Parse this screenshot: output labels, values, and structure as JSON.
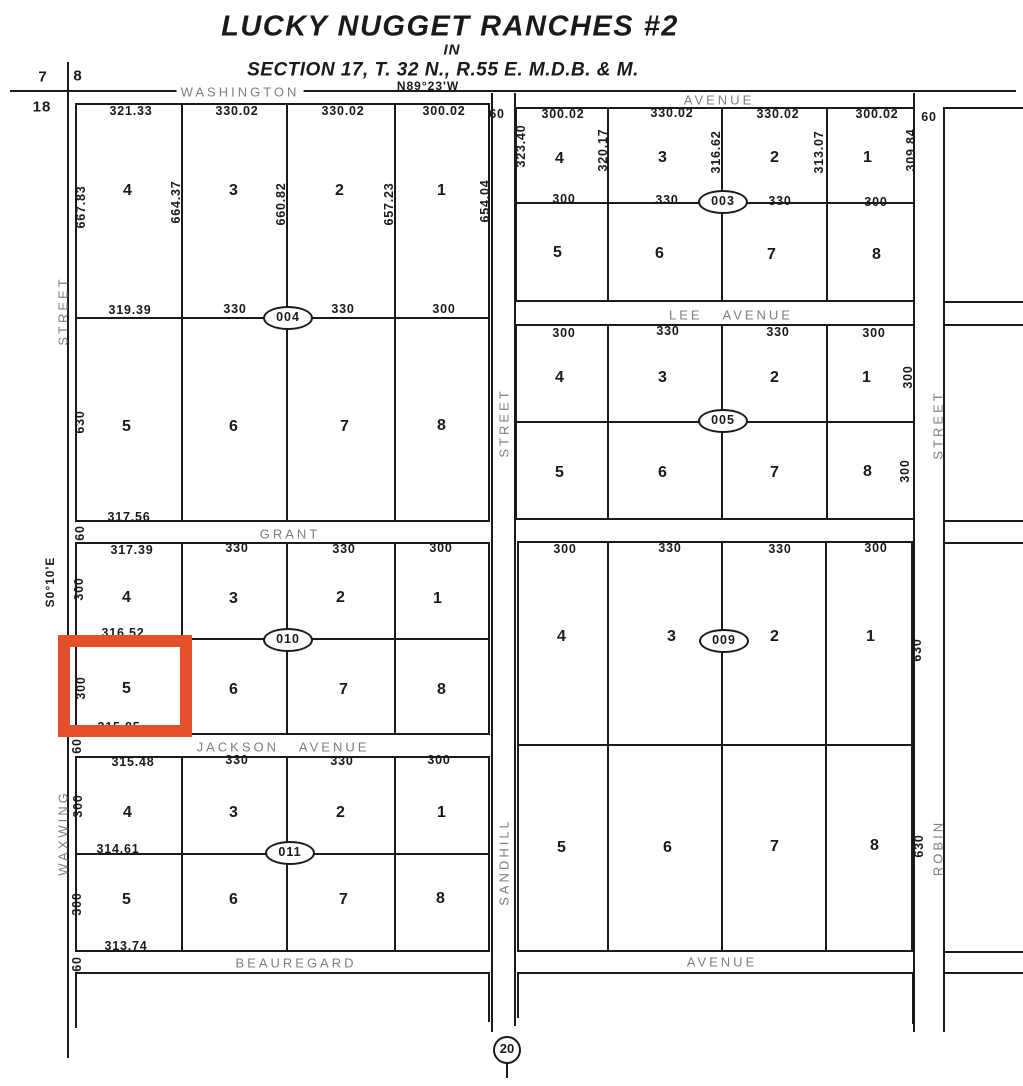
{
  "header": {
    "title": "LUCKY NUGGET RANCHES #2",
    "in_label": "IN",
    "section_line": "SECTION 17, T. 32 N., R.55 E. M.D.B. & M."
  },
  "bearings": {
    "north_line": "N89°23'W",
    "west_line": "S0°10'E"
  },
  "section_markers": {
    "nw_left": "7",
    "nw_right": "8",
    "nw_lower": "18",
    "south": "20"
  },
  "streets": {
    "washington": "WASHINGTON",
    "washington_suffix": "AVENUE",
    "lee": "LEE AVENUE",
    "grant": "GRANT",
    "jackson": "JACKSON AVENUE",
    "beauregard": "BEAUREGARD",
    "beauregard_suffix": "AVENUE",
    "waxwing": "WAXWING",
    "waxwing_type": "STREET",
    "sandhill": "SANDHILL",
    "sandhill_type": "STREET",
    "robin": "ROBIN",
    "robin_type": "STREET",
    "width": "60"
  },
  "blocks": {
    "b004": {
      "number": "004",
      "lots": [
        "4",
        "3",
        "2",
        "1",
        "5",
        "6",
        "7",
        "8"
      ],
      "top_dims": [
        "321.33",
        "330.02",
        "330.02",
        "300.02"
      ],
      "mid_dims": [
        "319.39",
        "330",
        "330",
        "300"
      ],
      "bottom_dim": "317.56",
      "depth_dims": [
        "667.83",
        "664.37",
        "660.82",
        "657.23",
        "654.04"
      ],
      "left_lower_depth": "630"
    },
    "b003": {
      "number": "003",
      "lots": [
        "4",
        "3",
        "2",
        "1",
        "5",
        "6",
        "7",
        "8"
      ],
      "top_dims": [
        "300.02",
        "330.02",
        "330.02",
        "300.02"
      ],
      "mid_dims": [
        "300",
        "330",
        "330",
        "300"
      ],
      "depth_dims": [
        "323.40",
        "320.17",
        "316.62",
        "313.07",
        "309.84"
      ]
    },
    "b005": {
      "number": "005",
      "lots": [
        "4",
        "3",
        "2",
        "1",
        "5",
        "6",
        "7",
        "8"
      ],
      "top_dims": [
        "300",
        "330",
        "330",
        "300"
      ],
      "right_depths": [
        "300",
        "300"
      ]
    },
    "b010": {
      "number": "010",
      "lots": [
        "4",
        "3",
        "2",
        "1",
        "5",
        "6",
        "7",
        "8"
      ],
      "top_dims": [
        "317.39",
        "330",
        "330",
        "300"
      ],
      "left_depths": [
        "300",
        "300"
      ],
      "mid_dim": "316.52",
      "bottom_dim": "315.85"
    },
    "b009": {
      "number": "009",
      "lots": [
        "4",
        "3",
        "2",
        "1",
        "5",
        "6",
        "7",
        "8"
      ],
      "top_dims": [
        "300",
        "330",
        "330",
        "300"
      ],
      "right_depths": [
        "630",
        "630"
      ]
    },
    "b011": {
      "number": "011",
      "lots": [
        "4",
        "3",
        "2",
        "1",
        "5",
        "6",
        "7",
        "8"
      ],
      "top_dims": [
        "315.48",
        "330",
        "330",
        "300"
      ],
      "left_depths": [
        "300",
        "300"
      ],
      "mid_dim": "314.61",
      "bottom_dim": "313.74"
    }
  },
  "highlight": {
    "block": "010",
    "lot": "5",
    "color": "#e4502c"
  },
  "colors": {
    "ink": "#1a1a1a",
    "street_label": "#7e7e7e",
    "background": "#ffffff"
  }
}
